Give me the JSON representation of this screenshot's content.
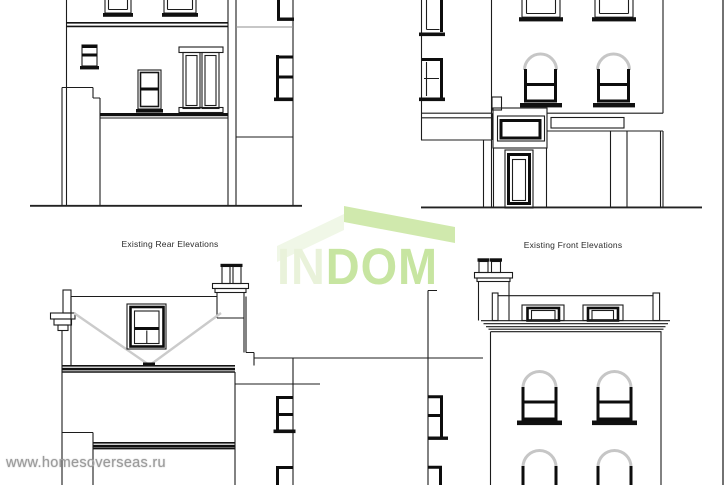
{
  "page": {
    "background": "#ffffff",
    "border_right_color": "#4f4f4f"
  },
  "titles": {
    "rear": "Existing Rear Elevations",
    "front": "Existing Front Elevations",
    "color": "#2b2b2b"
  },
  "watermark_url": {
    "text": "www.homesoverseas.ru",
    "color": "#9b9b9b"
  },
  "logo": {
    "part1": "IN",
    "part2": "DOM",
    "part1_color": "#e9f2da",
    "part2_color": "#c7e5a1",
    "roof_left_color": "#f0f7e7",
    "roof_right_color": "#d0e9ad"
  },
  "drawing": {
    "line_color": "#1c1c1c",
    "heavy_color": "#101010",
    "soft_gray": "#8f8f8f",
    "valley_gray": "#cbcbcb",
    "views": [
      {
        "id": "rear-elevation-upper",
        "description_label": "Existing Rear Elevations"
      },
      {
        "id": "front-elevation-upper",
        "description_label": "Existing Front Elevations"
      },
      {
        "id": "rear-elevation-lower",
        "description_label": "Existing Rear Elevations"
      },
      {
        "id": "front-elevation-lower",
        "description_label": "Existing Front Elevations"
      }
    ]
  }
}
